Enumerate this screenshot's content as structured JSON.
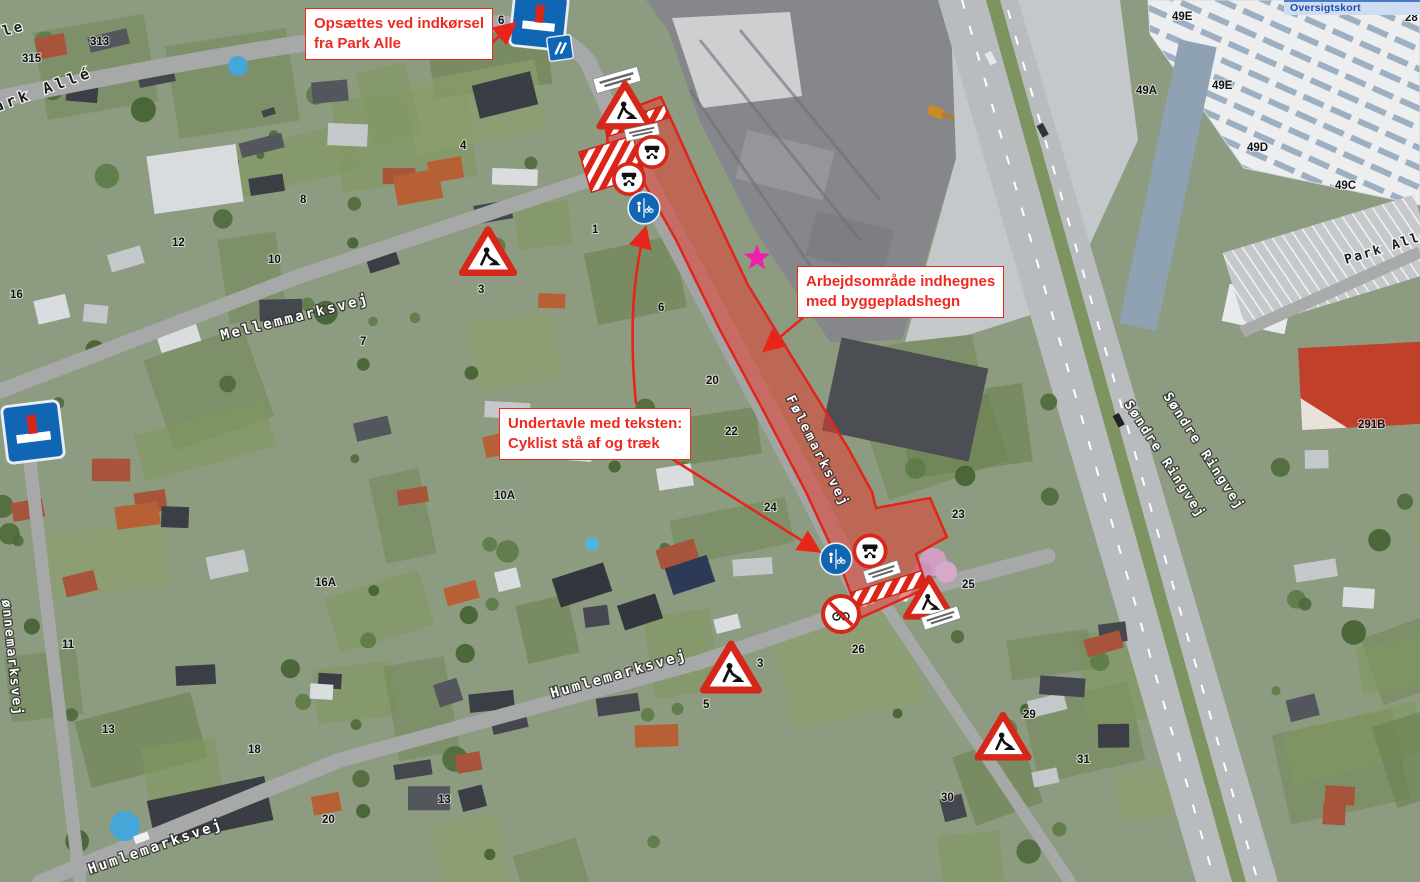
{
  "map": {
    "overlay_title": "Oversigtskort",
    "annotations": [
      {
        "id": "opsaettes",
        "x": 305,
        "y": 8,
        "text_lines": [
          "Opsættes ved indkørsel",
          "fra Park Alle"
        ]
      },
      {
        "id": "arbejdsomraade",
        "x": 797,
        "y": 266,
        "text_lines": [
          "Arbejdsområde indhegnes",
          "med byggepladshegn"
        ]
      },
      {
        "id": "undertavle",
        "x": 499,
        "y": 408,
        "text_lines": [
          "Undertavle med teksten:",
          "Cyklist stå af og træk"
        ]
      }
    ],
    "arrows": [
      {
        "x1": 489,
        "y1": 45,
        "x2": 513,
        "y2": 25
      },
      {
        "path": "M636,404 Q626,300 645,230",
        "x2": 645,
        "y2": 230
      },
      {
        "x1": 672,
        "y1": 459,
        "x2": 817,
        "y2": 550
      },
      {
        "x1": 812,
        "y1": 310,
        "x2": 766,
        "y2": 349
      }
    ],
    "street_labels": [
      {
        "text": "le",
        "x": 4,
        "y": 36,
        "rot": -16,
        "style": "dark",
        "size": 14,
        "sp": 3
      },
      {
        "text": "ark Allé",
        "x": -4,
        "y": 112,
        "rot": -20,
        "style": "dark",
        "size": 15,
        "sp": 4
      },
      {
        "text": "Mellemmarksvej",
        "x": 222,
        "y": 340,
        "rot": -14,
        "style": "light",
        "size": 14,
        "sp": 2.5
      },
      {
        "text": "Følemarksvej",
        "x": 786,
        "y": 398,
        "rot": 63,
        "style": "light",
        "size": 13,
        "sp": 2.5
      },
      {
        "text": "Søndre Ringvej",
        "x": 1124,
        "y": 404,
        "rot": 57,
        "style": "light",
        "size": 13,
        "sp": 2
      },
      {
        "text": "Søndre Ringvej",
        "x": 1163,
        "y": 396,
        "rot": 57,
        "style": "light",
        "size": 13,
        "sp": 2
      },
      {
        "text": "Park Allé",
        "x": 1346,
        "y": 264,
        "rot": -17,
        "style": "dark",
        "size": 13,
        "sp": 2
      },
      {
        "text": "Humlemarksvej",
        "x": 552,
        "y": 698,
        "rot": -16,
        "style": "light",
        "size": 14,
        "sp": 2.5
      },
      {
        "text": "Humlemarksvej",
        "x": 90,
        "y": 874,
        "rot": -19,
        "style": "light",
        "size": 14,
        "sp": 2.5
      },
      {
        "text": "ønnemarksvej",
        "x": 2,
        "y": 600,
        "rot": 84,
        "style": "light",
        "size": 13,
        "sp": 2
      }
    ],
    "house_numbers": [
      {
        "t": "313",
        "x": 90,
        "y": 45
      },
      {
        "t": "315",
        "x": 22,
        "y": 62
      },
      {
        "t": "6",
        "x": 498,
        "y": 24
      },
      {
        "t": "12",
        "x": 172,
        "y": 246
      },
      {
        "t": "10",
        "x": 268,
        "y": 263
      },
      {
        "t": "16",
        "x": 10,
        "y": 298
      },
      {
        "t": "8",
        "x": 300,
        "y": 203
      },
      {
        "t": "4",
        "x": 460,
        "y": 149
      },
      {
        "t": "1",
        "x": 592,
        "y": 233
      },
      {
        "t": "3",
        "x": 478,
        "y": 293
      },
      {
        "t": "7",
        "x": 360,
        "y": 345
      },
      {
        "t": "6",
        "x": 658,
        "y": 311
      },
      {
        "t": "16A",
        "x": 315,
        "y": 586
      },
      {
        "t": "10A",
        "x": 494,
        "y": 499
      },
      {
        "t": "18",
        "x": 248,
        "y": 753
      },
      {
        "t": "11",
        "x": 62,
        "y": 648
      },
      {
        "t": "13",
        "x": 102,
        "y": 733
      },
      {
        "t": "13",
        "x": 438,
        "y": 803
      },
      {
        "t": "20",
        "x": 706,
        "y": 384
      },
      {
        "t": "22",
        "x": 725,
        "y": 435
      },
      {
        "t": "24",
        "x": 764,
        "y": 511
      },
      {
        "t": "26",
        "x": 852,
        "y": 653
      },
      {
        "t": "23",
        "x": 952,
        "y": 518
      },
      {
        "t": "25",
        "x": 962,
        "y": 588
      },
      {
        "t": "29",
        "x": 1023,
        "y": 718
      },
      {
        "t": "31",
        "x": 1077,
        "y": 763
      },
      {
        "t": "30",
        "x": 941,
        "y": 801
      },
      {
        "t": "3",
        "x": 757,
        "y": 667
      },
      {
        "t": "5",
        "x": 703,
        "y": 708
      },
      {
        "t": "20",
        "x": 322,
        "y": 823
      },
      {
        "t": "49E",
        "x": 1172,
        "y": 20
      },
      {
        "t": "49A",
        "x": 1136,
        "y": 94
      },
      {
        "t": "49E",
        "x": 1212,
        "y": 89
      },
      {
        "t": "49D",
        "x": 1247,
        "y": 151
      },
      {
        "t": "49C",
        "x": 1335,
        "y": 189
      },
      {
        "t": "28",
        "x": 1405,
        "y": 21
      },
      {
        "t": "291B",
        "x": 1358,
        "y": 428
      }
    ],
    "signs": [
      {
        "name": "dead-end-sign",
        "type": "dead_end",
        "x": 539,
        "y": 21,
        "s": 54,
        "rot": 6
      },
      {
        "name": "blue-info-sign",
        "type": "info_blue",
        "x": 560,
        "y": 48,
        "s": 24,
        "rot": -8
      },
      {
        "name": "work-plate",
        "type": "plate",
        "x": 617,
        "y": 80,
        "w": 46,
        "h": 15,
        "rot": -16
      },
      {
        "name": "roadwork-sign",
        "type": "roadwork",
        "x": 625,
        "y": 107,
        "s": 46,
        "rot": 0
      },
      {
        "name": "work-plate",
        "type": "plate",
        "x": 642,
        "y": 132,
        "w": 34,
        "h": 12,
        "rot": -12
      },
      {
        "name": "no-motor-vehicles-sign",
        "type": "no_motor",
        "x": 652,
        "y": 152,
        "s": 33,
        "rot": 0
      },
      {
        "name": "no-motor-vehicles-sign",
        "type": "no_motor",
        "x": 629,
        "y": 179,
        "s": 33,
        "rot": 0
      },
      {
        "name": "shared-path-sign",
        "type": "shared_path",
        "x": 644,
        "y": 208,
        "s": 33,
        "rot": 0
      },
      {
        "name": "roadwork-sign",
        "type": "roadwork",
        "x": 488,
        "y": 253,
        "s": 47,
        "rot": 0
      },
      {
        "name": "dead-end-sign",
        "type": "dead_end",
        "x": 33,
        "y": 432,
        "s": 57,
        "rot": -7
      },
      {
        "name": "shared-path-sign",
        "type": "shared_path",
        "x": 836,
        "y": 559,
        "s": 33,
        "rot": 0
      },
      {
        "name": "no-motor-vehicles-sign",
        "type": "no_motor",
        "x": 870,
        "y": 551,
        "s": 34,
        "rot": 0
      },
      {
        "name": "work-plate",
        "type": "plate",
        "x": 882,
        "y": 572,
        "w": 36,
        "h": 13,
        "rot": -18
      },
      {
        "name": "no-bicycles-sign",
        "type": "no_bike",
        "x": 841,
        "y": 614,
        "s": 40,
        "rot": 0
      },
      {
        "name": "roadwork-sign",
        "type": "roadwork",
        "x": 929,
        "y": 599,
        "s": 42,
        "rot": 0
      },
      {
        "name": "work-plate",
        "type": "plate",
        "x": 941,
        "y": 618,
        "w": 38,
        "h": 13,
        "rot": -18
      },
      {
        "name": "roadwork-sign",
        "type": "roadwork",
        "x": 731,
        "y": 669,
        "s": 50,
        "rot": 0
      },
      {
        "name": "roadwork-sign",
        "type": "roadwork",
        "x": 1003,
        "y": 738,
        "s": 46,
        "rot": 0
      }
    ],
    "work_zone": {
      "polygon": "606,118 661,97 702,188 748,285 800,370 848,448 872,492 876,508 930,498 947,537 916,554 927,588 860,618 842,570 806,492 762,408 720,330 676,240 638,172 608,150",
      "fill": "rgba(228,62,50,0.55)",
      "stroke": "#e1251b",
      "barriers": [
        {
          "x": 636,
          "y": 121,
          "w": 64,
          "h": 13,
          "rot": -17
        },
        {
          "x": 888,
          "y": 589,
          "w": 74,
          "h": 15,
          "rot": -17
        }
      ],
      "cross_block": {
        "x": 612,
        "y": 164,
        "w": 56,
        "h": 42,
        "rot": -17
      }
    },
    "star": {
      "x": 757,
      "y": 258,
      "color": "#f21fad"
    },
    "colors": {
      "note_red": "#ee2a20",
      "zone_stroke": "#e1251b",
      "sign_blue": "#1166b4",
      "sign_red": "#d6271b",
      "label_halo_dark": "#2a2a2a",
      "label_halo_light": "#ffffff"
    }
  }
}
